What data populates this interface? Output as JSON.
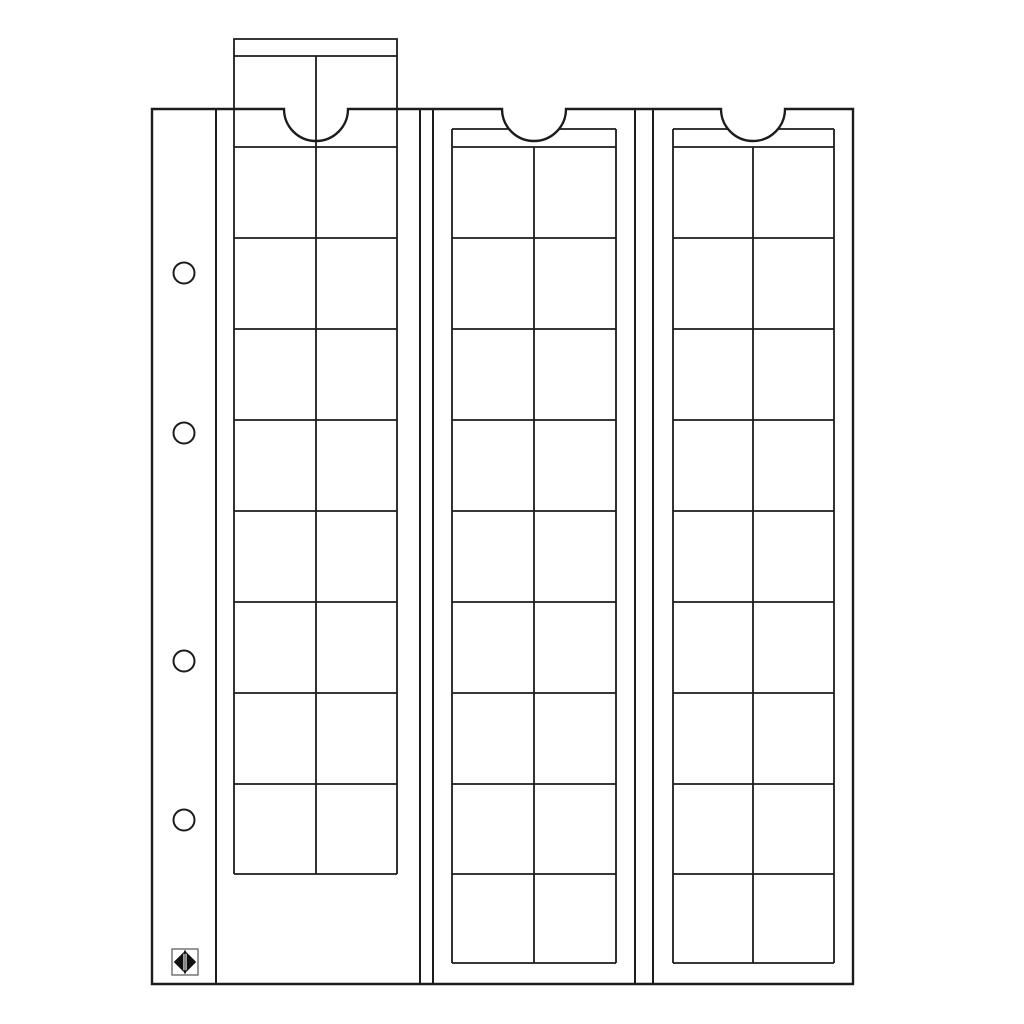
{
  "meta": {
    "description": "Black-and-white technical line drawing of a ring-binder coin album page (OPTIMA-style sheet) with three vertical coin pocket strips",
    "figure_type": "product-line-drawing"
  },
  "colors": {
    "background": "#ffffff",
    "line": "#1c1c1c",
    "logo_frame": "#6b6b6b",
    "logo_fill": "#111111",
    "white": "#ffffff"
  },
  "sheet": {
    "binder_holes_count": 4,
    "strip_count": 3,
    "strips": [
      {
        "id": 1,
        "state": "pulled-out-top",
        "columns": 2,
        "rows": 9,
        "has_header_tab": true,
        "has_thumb_notch": true
      },
      {
        "id": 2,
        "state": "inserted",
        "columns": 2,
        "rows": 9,
        "has_header_tab": true,
        "has_thumb_notch": true
      },
      {
        "id": 3,
        "state": "inserted",
        "columns": 2,
        "rows": 9,
        "has_header_tab": true,
        "has_thumb_notch": true
      }
    ]
  },
  "logo": {
    "name": "diamond-compass-logo"
  }
}
